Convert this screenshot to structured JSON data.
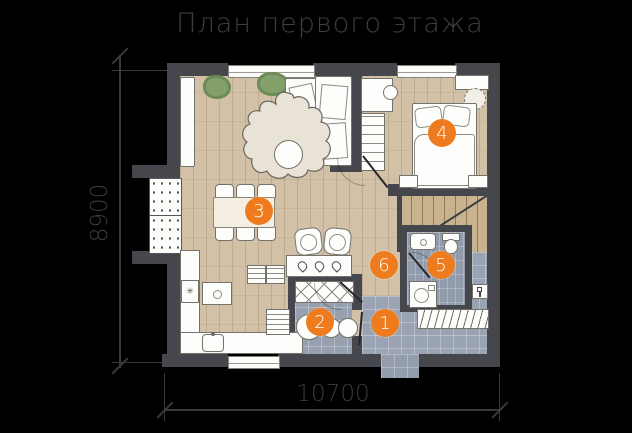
{
  "title": "План первого этажа",
  "dimensions": {
    "height_label": "8900",
    "width_label": "10700"
  },
  "rooms": [
    {
      "number": "1"
    },
    {
      "number": "2"
    },
    {
      "number": "3"
    },
    {
      "number": "4"
    },
    {
      "number": "5"
    },
    {
      "number": "6"
    }
  ],
  "icons": {
    "fridge_snowflake": "✳"
  },
  "colors": {
    "background": "#000000",
    "marker_accent": "#ee7c1e",
    "wall": "#45474c",
    "wood_floor": "#d2c1a6",
    "tile_floor": "#9aa3b1",
    "annotation": "#3b3b3d"
  }
}
